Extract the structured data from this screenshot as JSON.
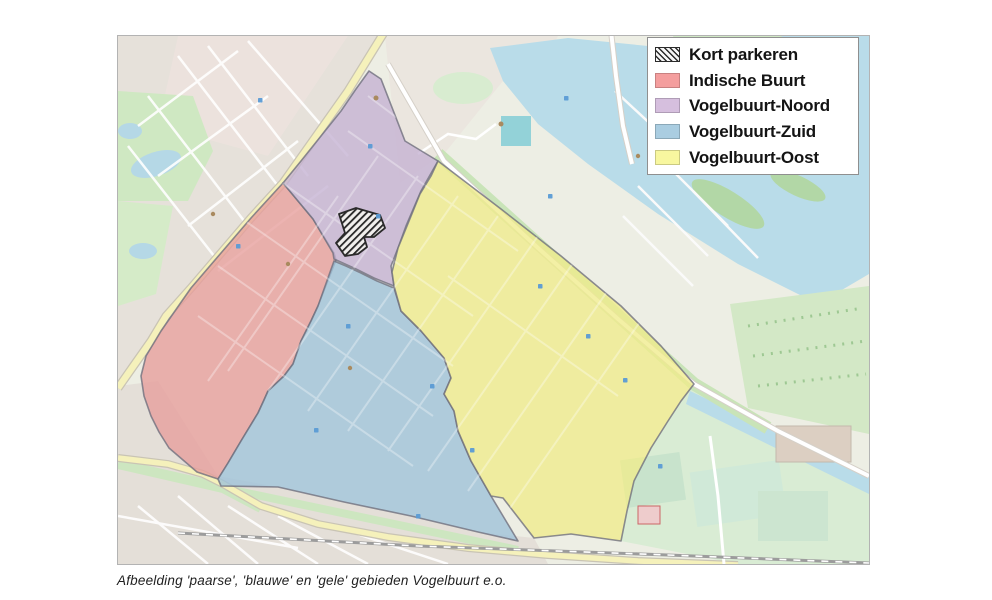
{
  "legend": {
    "items": [
      {
        "id": "kort-parkeren",
        "label": "Kort parkeren",
        "swatch": "hatch",
        "color": null
      },
      {
        "id": "indische-buurt",
        "label": "Indische Buurt",
        "swatch": "color",
        "color": "#f49e9e"
      },
      {
        "id": "vogelbuurt-noord",
        "label": "Vogelbuurt-Noord",
        "swatch": "color",
        "color": "#d6bfde"
      },
      {
        "id": "vogelbuurt-zuid",
        "label": "Vogelbuurt-Zuid",
        "swatch": "color",
        "color": "#aacde1"
      },
      {
        "id": "vogelbuurt-oost",
        "label": "Vogelbuurt-Oost",
        "swatch": "color",
        "color": "#f8f79f"
      }
    ]
  },
  "zones": {
    "kort_parkeren": {
      "name": "Kort parkeren"
    },
    "indische_buurt": {
      "name": "Indische Buurt",
      "fill": "#e79d9b"
    },
    "vogelbuurt_noord": {
      "name": "Vogelbuurt-Noord",
      "fill": "#c4b1d2"
    },
    "vogelbuurt_zuid": {
      "name": "Vogelbuurt-Zuid",
      "fill": "#9dc2d8"
    },
    "vogelbuurt_oost": {
      "name": "Vogelbuurt-Oost",
      "fill": "#efec8c"
    }
  },
  "caption": "Afbeelding 'paarse', 'blauwe' en 'gele' gebieden Vogelbuurt e.o."
}
